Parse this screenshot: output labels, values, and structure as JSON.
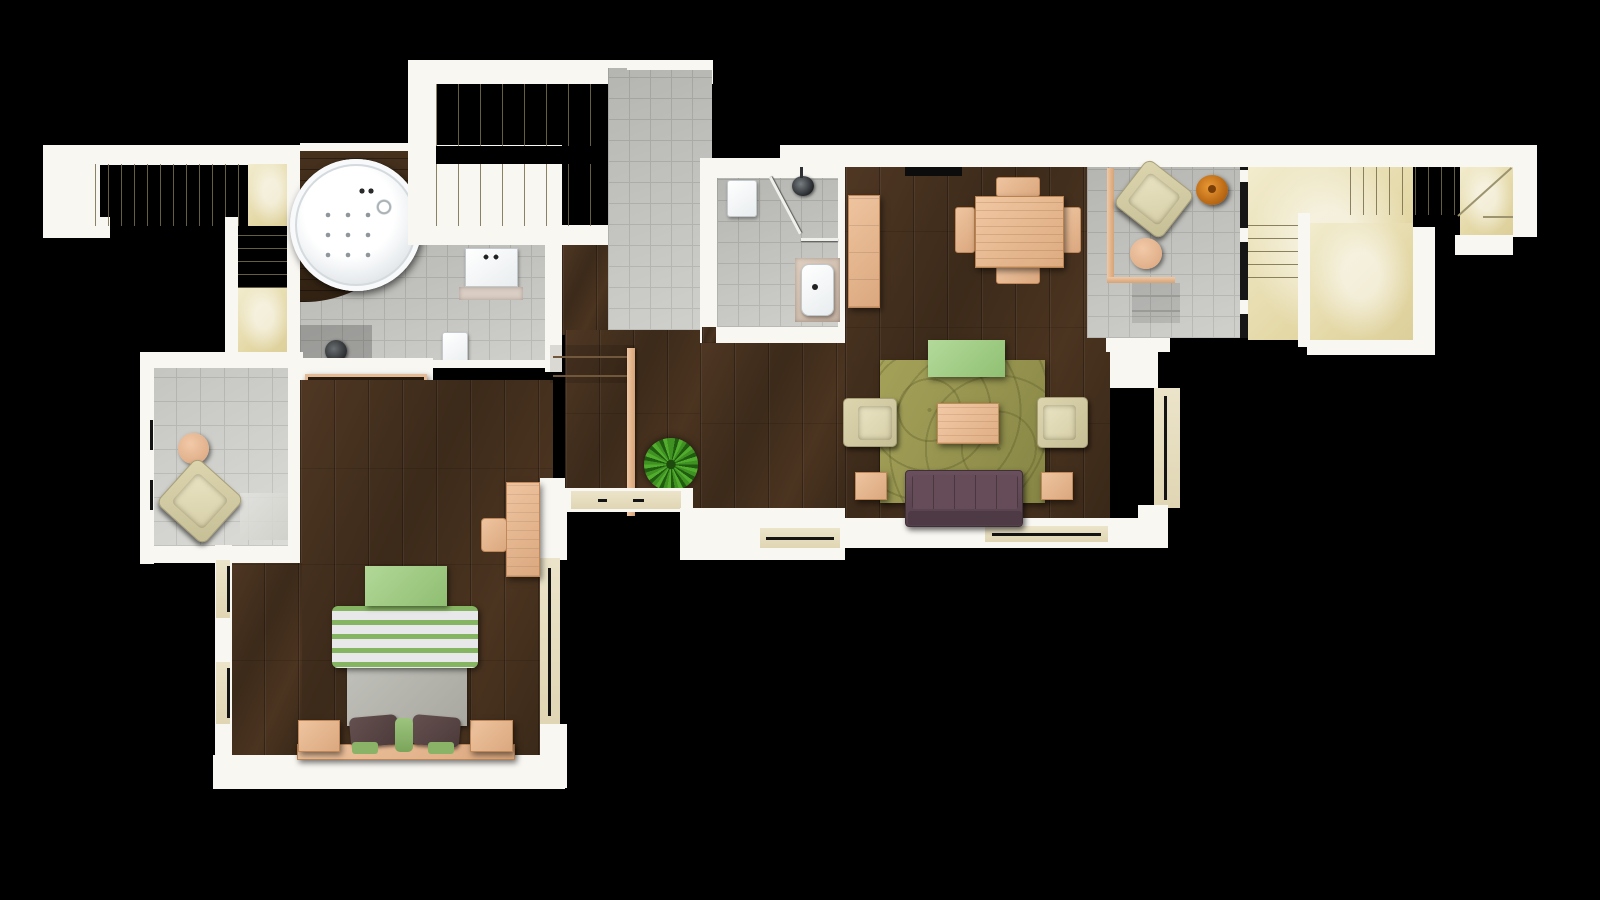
{
  "scene": {
    "type": "architectural floor plan, top-down 3D render",
    "background": "#000000",
    "visible_text": "none"
  },
  "palette": {
    "wall": "#f9f7f2",
    "stair_cream": "#eee5c0",
    "stair_line": "#9c936f",
    "tile": "#c9c9c5",
    "tile_line": "#b3b3af",
    "tile_light": "#d5d5d1",
    "wood": "#45301e",
    "wood_dark": "#3a2817",
    "peach": "#e9bd9c",
    "peach_dark": "#c08758",
    "cream_furniture": "#d2cba2",
    "green": "#a7d08b",
    "rug": "#9a984f",
    "sofa": "#5e4550",
    "fixture_white": "#f4f6f7",
    "plant_green": "#3f8f25",
    "lamp_orange": "#d07b1e",
    "window": "#eae2c8",
    "line_dark": "#141414"
  },
  "rooms": [
    {
      "name": "exterior-stair-west",
      "floor": "cream stone steps"
    },
    {
      "name": "stairwell-top",
      "floor": "cream steps with void band"
    },
    {
      "name": "stair-hall-tiled",
      "floor": "grey tile"
    },
    {
      "name": "bathroom-jacuzzi",
      "floor": "grey tile + dark wood tub platform"
    },
    {
      "name": "terrace-west",
      "floor": "large grey tile"
    },
    {
      "name": "bedroom",
      "floor": "dark wood plank"
    },
    {
      "name": "hallway",
      "floor": "dark wood plank with two steps"
    },
    {
      "name": "bathroom-shower",
      "floor": "grey tile"
    },
    {
      "name": "living-dining-room",
      "floor": "dark wood plank"
    },
    {
      "name": "reading-corner",
      "floor": "grey tile"
    },
    {
      "name": "terrace-east",
      "floor": "cream stone"
    },
    {
      "name": "exterior-stair-east",
      "floor": "cream steps with winder"
    }
  ],
  "furniture": [
    {
      "item": "round-jacuzzi-tub",
      "room": "bathroom-jacuzzi"
    },
    {
      "item": "washbasin",
      "room": "bathroom-jacuzzi"
    },
    {
      "item": "toilet",
      "room": "bathroom-jacuzzi"
    },
    {
      "item": "shower-fixture",
      "room": "bathroom-jacuzzi"
    },
    {
      "item": "storage-shelf-with-towels",
      "room": "bathroom-jacuzzi"
    },
    {
      "item": "lounge-armchair",
      "room": "terrace-west"
    },
    {
      "item": "round-side-table",
      "room": "terrace-west"
    },
    {
      "item": "double-bed-green-striped",
      "room": "bedroom"
    },
    {
      "item": "nightstand",
      "count": 2,
      "room": "bedroom"
    },
    {
      "item": "pillow-brown",
      "count": 2,
      "room": "bedroom"
    },
    {
      "item": "foot-bench-green",
      "room": "bedroom"
    },
    {
      "item": "desk",
      "room": "bedroom"
    },
    {
      "item": "desk-chair",
      "room": "bedroom"
    },
    {
      "item": "potted-plant",
      "count": 2,
      "room": "hallway"
    },
    {
      "item": "wood-railing",
      "room": "hallway"
    },
    {
      "item": "toilet",
      "room": "bathroom-shower"
    },
    {
      "item": "corner-shower",
      "room": "bathroom-shower"
    },
    {
      "item": "washbasin-counter",
      "room": "bathroom-shower"
    },
    {
      "item": "tall-cabinet",
      "room": "living-dining-room"
    },
    {
      "item": "tv-wall-unit",
      "room": "living-dining-room"
    },
    {
      "item": "dining-table",
      "room": "living-dining-room"
    },
    {
      "item": "dining-chair",
      "count": 4,
      "room": "living-dining-room"
    },
    {
      "item": "area-rug-olive",
      "room": "living-dining-room"
    },
    {
      "item": "green-ottoman",
      "room": "living-dining-room"
    },
    {
      "item": "coffee-table",
      "room": "living-dining-room"
    },
    {
      "item": "armchair-cream",
      "count": 2,
      "room": "living-dining-room"
    },
    {
      "item": "sofa-purple",
      "room": "living-dining-room"
    },
    {
      "item": "side-table",
      "count": 2,
      "room": "living-dining-room"
    },
    {
      "item": "reading-armchair",
      "room": "reading-corner"
    },
    {
      "item": "floor-lamp-orange",
      "room": "reading-corner"
    },
    {
      "item": "round-side-table",
      "room": "reading-corner"
    }
  ]
}
